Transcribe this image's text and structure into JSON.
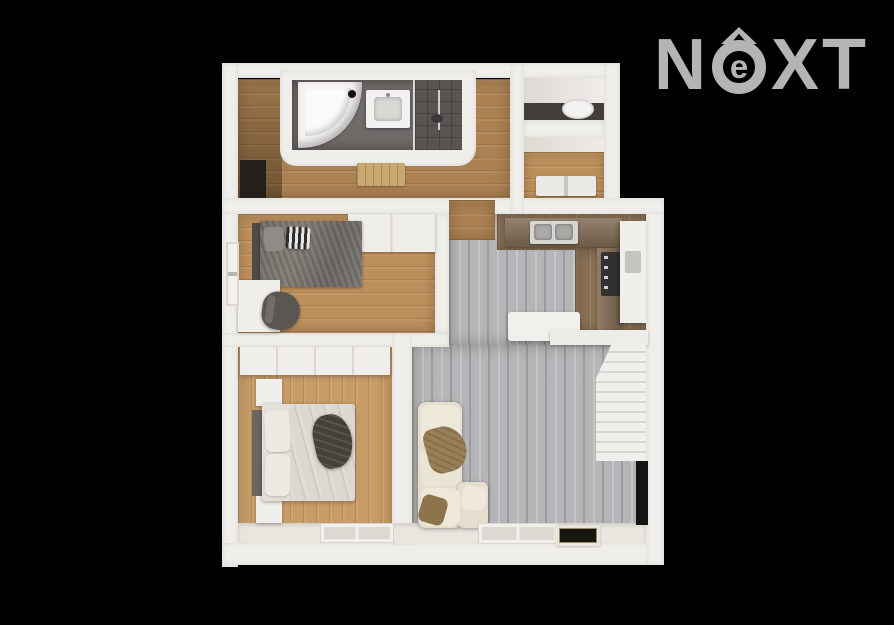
{
  "background_color": "#000000",
  "logo": {
    "brand": "NEXT",
    "text_before": "N",
    "circle_letter": "e",
    "text_after": "XT",
    "color": "#b4b4b4"
  },
  "colors": {
    "bg": "#000000",
    "logo": "#b4b4b4",
    "wall": "#f0eeea",
    "hall-wood": "#ab8152",
    "oak-wood": "#bd8f5b",
    "oak-light": "#c89c67",
    "gray-floor": "#b5b4b6",
    "counter-wood": "#7c664f",
    "kitchen-wood": "#8a7054",
    "tile": "#6e6b68",
    "tile-dark": "#575452",
    "sofa": "#e5decf",
    "blanket": "#997f57",
    "bed-light": "#e3e0da",
    "tv": "#151515",
    "mat": "#17170f",
    "stove": "#343231",
    "toilet": "#f5f4f2",
    "dark-wall": "#413d39"
  },
  "floorplan": {
    "style": "3d-top-down-render",
    "rooms": [
      {
        "name": "bathroom",
        "floor": "dark-tile",
        "items": [
          "corner-bathtub",
          "vanity-sink",
          "walk-in-shower",
          "glass-partition"
        ]
      },
      {
        "name": "hallway",
        "floor": "oak",
        "items": [
          "entry-door",
          "cabinet"
        ]
      },
      {
        "name": "wc",
        "floor": "dark-tile",
        "items": [
          "toilet"
        ]
      },
      {
        "name": "storage-room",
        "floor": "oak",
        "items": [
          "drawer-cabinets"
        ]
      },
      {
        "name": "kids-bedroom",
        "floor": "oak",
        "items": [
          "single-bed",
          "striped-pillow",
          "desk",
          "office-chair",
          "wall-shelf",
          "window"
        ]
      },
      {
        "name": "master-bedroom",
        "floor": "oak",
        "items": [
          "double-bed",
          "wardrobe",
          "nightstand",
          "nightstand",
          "clothes-pile",
          "window"
        ]
      },
      {
        "name": "living-room-with-kitchen",
        "floor": "gray-plank",
        "items": [
          "kitchen-counter",
          "double-sink",
          "stove",
          "tall-cabinet",
          "island",
          "staircase",
          "corner-sofa",
          "throw-blanket",
          "tv",
          "doormat",
          "window"
        ]
      }
    ]
  }
}
